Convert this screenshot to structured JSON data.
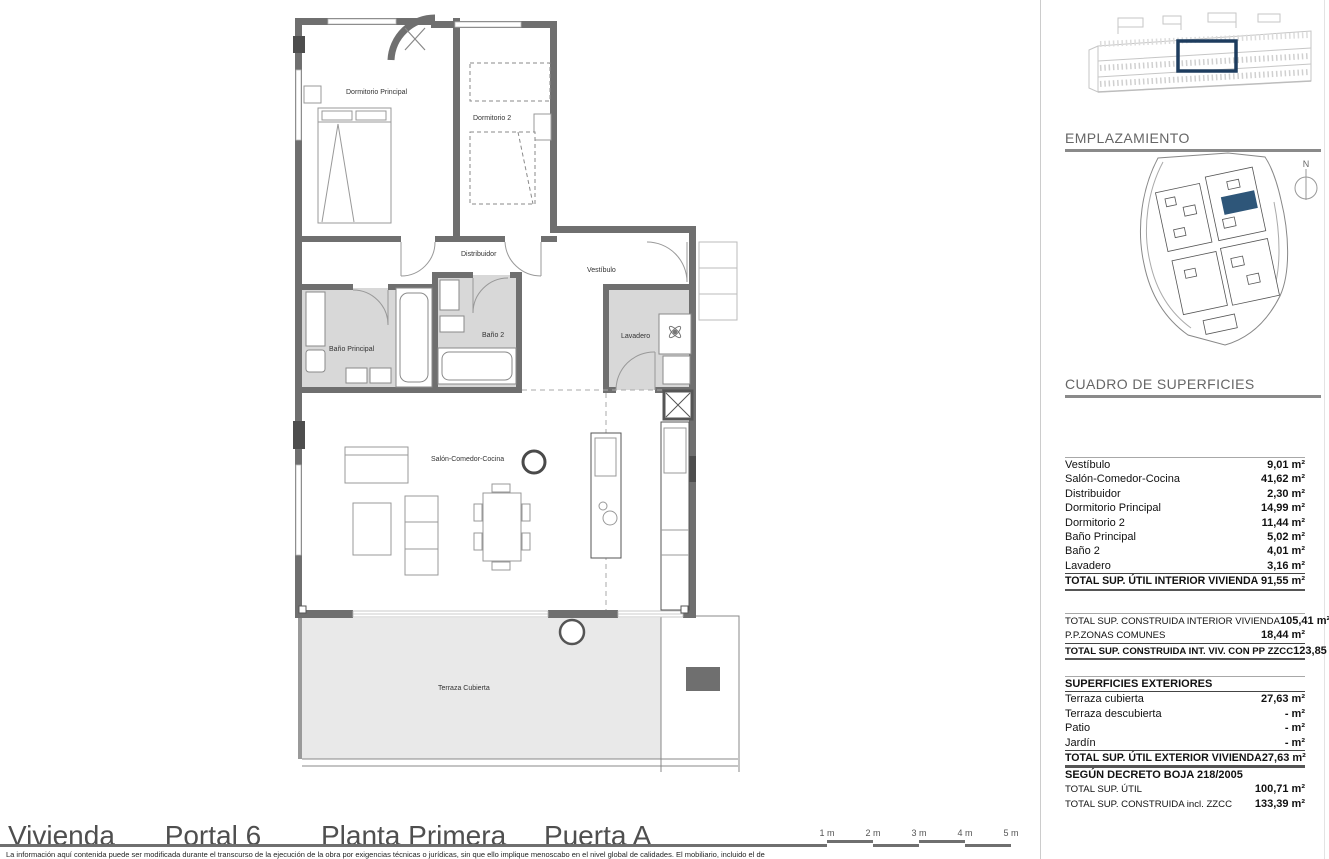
{
  "colors": {
    "wall": "#6f6f6f",
    "wall_dark": "#4d4d4d",
    "bath_floor": "#d8d8d8",
    "terrace_floor": "#e9e9e9",
    "accent_blue_outline": "#1d3c5e",
    "accent_blue_fill": "#2e5679"
  },
  "plan": {
    "rooms": {
      "dormitorio_principal": "Dormitorio Principal",
      "dormitorio_2": "Dormitorio 2",
      "distribuidor": "Distribuidor",
      "vestibulo": "Vestíbulo",
      "bano_principal": "Baño Principal",
      "bano_2": "Baño 2",
      "lavadero": "Lavadero",
      "salon": "Salón-Comedor-Cocina",
      "terraza": "Terraza Cubierta"
    }
  },
  "sidebar": {
    "emplazamiento_title": "EMPLAZAMIENTO",
    "compass_label": "N",
    "cuadro_title": "CUADRO DE SUPERFICIES",
    "tables": {
      "interior": {
        "rows": [
          {
            "label": "Vestíbulo",
            "value": "9,01 m²"
          },
          {
            "label": "Salón-Comedor-Cocina",
            "value": "41,62 m²"
          },
          {
            "label": "Distribuidor",
            "value": "2,30 m²"
          },
          {
            "label": "Dormitorio Principal",
            "value": "14,99 m²"
          },
          {
            "label": "Dormitorio 2",
            "value": "11,44 m²"
          },
          {
            "label": "Baño Principal",
            "value": "5,02 m²"
          },
          {
            "label": "Baño 2",
            "value": "4,01 m²"
          },
          {
            "label": "Lavadero",
            "value": "3,16 m²"
          }
        ],
        "total": {
          "label": "TOTAL SUP. ÚTIL INTERIOR VIVIENDA",
          "value": "91,55 m²"
        }
      },
      "construida": {
        "rows": [
          {
            "label": "TOTAL SUP. CONSTRUIDA INTERIOR VIVIENDA",
            "value": "105,41 m²"
          },
          {
            "label": "P.P.ZONAS COMUNES",
            "value": "18,44 m²"
          }
        ],
        "total": {
          "label": "TOTAL SUP. CONSTRUIDA INT. VIV. CON PP ZZCC",
          "value": "123,85 m²"
        }
      },
      "exteriores": {
        "header": "SUPERFICIES EXTERIORES",
        "rows": [
          {
            "label": "Terraza cubierta",
            "value": "27,63 m²"
          },
          {
            "label": "Terraza descubierta",
            "value": "- m²"
          },
          {
            "label": "Patio",
            "value": "- m²"
          },
          {
            "label": "Jardín",
            "value": "- m²"
          }
        ],
        "total": {
          "label": "TOTAL SUP. ÚTIL EXTERIOR VIVIENDA",
          "value": "27,63 m²"
        }
      },
      "decreto": {
        "header": "SEGÚN DECRETO BOJA 218/2005",
        "rows": [
          {
            "label": "TOTAL SUP. ÚTIL",
            "value": "100,71 m²"
          },
          {
            "label": "TOTAL SUP. CONSTRUIDA incl. ZZCC",
            "value": "133,39 m²"
          }
        ]
      }
    }
  },
  "footer": {
    "title_parts": [
      "Vivienda",
      "Portal 6",
      "Planta Primera",
      "Puerta A"
    ],
    "scale_labels": [
      "1 m",
      "2 m",
      "3 m",
      "4 m",
      "5 m"
    ],
    "disclaimer": "La información aquí contenida puede ser modificada durante el transcurso de la ejecución de la obra por exigencias técnicas o jurídicas, sin que ello implique menoscabo en el nivel global de calidades. El mobiliario, incluido el de"
  }
}
